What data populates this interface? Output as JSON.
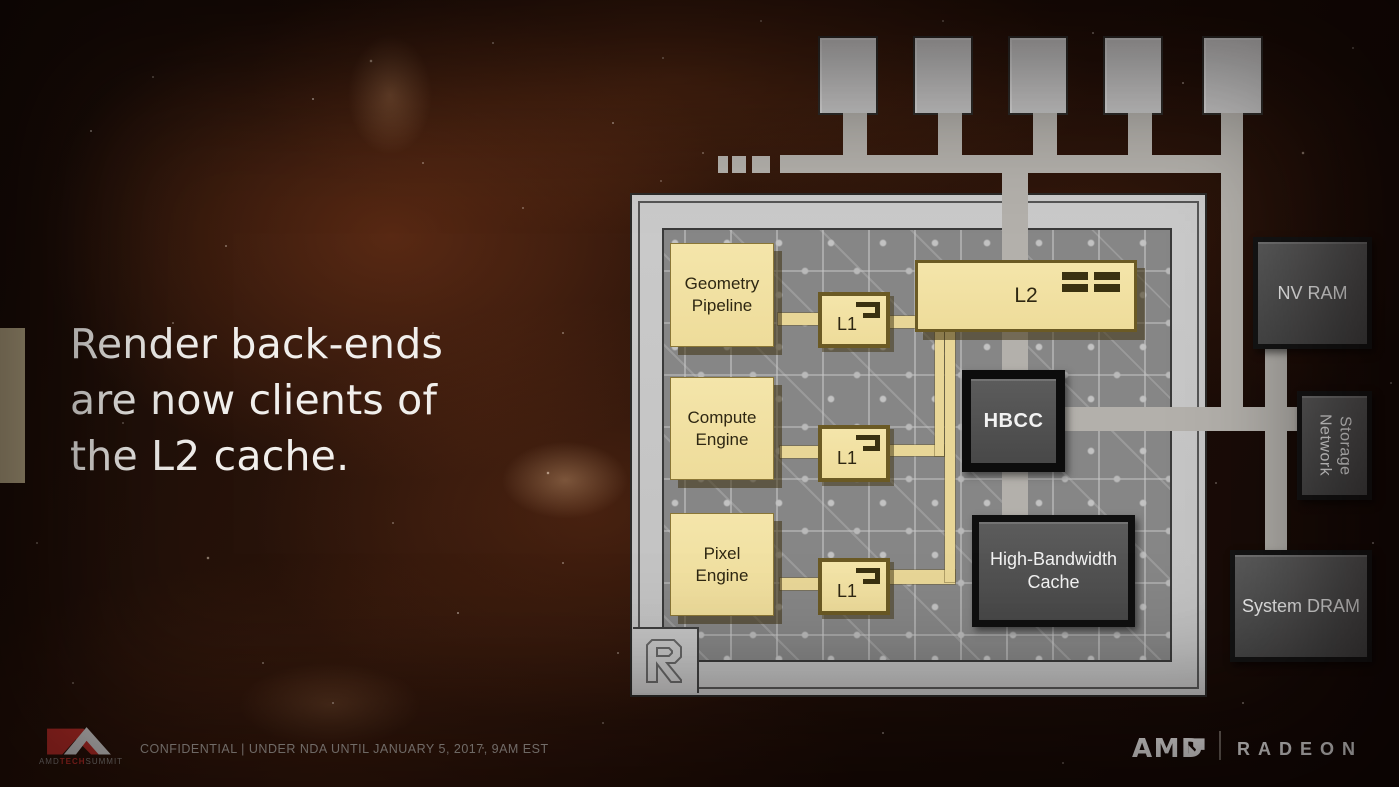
{
  "headline": {
    "lines": [
      "Render back-ends",
      "are now clients of",
      "the L2 cache."
    ]
  },
  "chip": {
    "monogram": "R",
    "blocks": {
      "geometry_pipeline": {
        "line1": "Geometry",
        "line2": "Pipeline"
      },
      "compute_engine": {
        "line1": "Compute",
        "line2": "Engine"
      },
      "pixel_engine": {
        "line1": "Pixel",
        "line2": "Engine"
      },
      "l1_geometry": "L1",
      "l1_compute": "L1",
      "l1_pixel": "L1",
      "l2": "L2",
      "hbcc": "HBCC",
      "high_bandwidth_cache": {
        "line1": "High-Bandwidth",
        "line2": "Cache"
      }
    }
  },
  "memory": {
    "nv_ram": "NV RAM",
    "network_storage": {
      "line1": "Network",
      "line2": "Storage"
    },
    "system_dram": "System DRAM"
  },
  "footer": {
    "confidential": "CONFIDENTIAL | UNDER NDA UNTIL JANUARY 5, 2017, 9AM EST",
    "summit_logo": {
      "amd": "AMD",
      "tech": "TECH",
      "summit": "SUMMIT"
    },
    "amd_wordmark": "AMD",
    "radeon_wordmark": "RADEON"
  },
  "colors": {
    "background_brown": "#2B140A",
    "accent_bar": "#CCBC95",
    "headline_text": "#F1EFEC",
    "block_yellow": "#F1E1A2",
    "block_yellow_border": "#6B5A24",
    "trace_yellow": "#E8D697",
    "chip_frame": "#C6C6C6",
    "circuit_board": "#868686",
    "connector_gray": "#B3B0AB",
    "dark_block": "#4C4C4C",
    "dark_block_border": "#141414",
    "logo_red": "#D8352F",
    "brand_white": "#FFFFFF"
  }
}
